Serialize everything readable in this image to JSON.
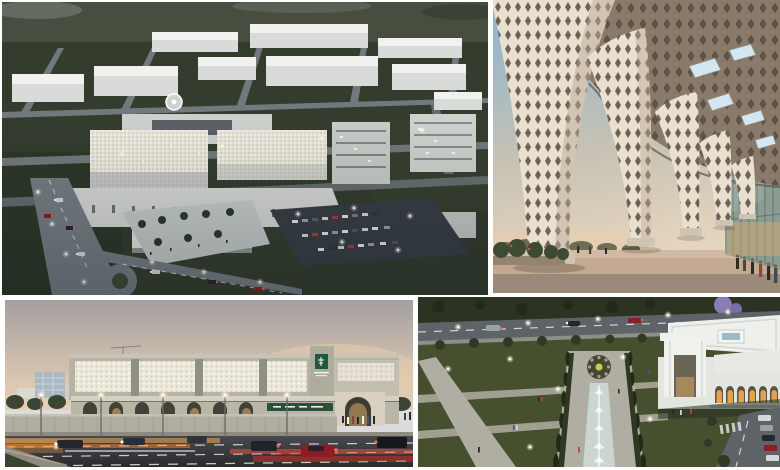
{
  "collage": {
    "type": "architectural-render-collage",
    "panel_count": 4,
    "panels": [
      {
        "id": "hospital-campus-aerial",
        "alt": "Aerial dusk rendering of a large hospital campus: white warehouse district behind, road grid on dark lawns, central beige medical complex with helipad, lit parking lot, avenue with roundabout and car lights"
      },
      {
        "id": "lattice-canopy-walkway",
        "alt": "Sunset view beneath a sculptural diamond-lattice canopy with flaring columns, rectangular skylights and a glass curtain wall with people at its base"
      },
      {
        "id": "hospital-street-elevation",
        "alt": "Street-level dusk rendering of a hospital with perforated mashrabiya facade panels, green signage, arched colonnade, boundary wall, jacaranda tree and traffic light trails"
      },
      {
        "id": "entrance-garden-aerial",
        "alt": "Aerial dusk rendering of a formal garden axis with water channel and fountains, cypress trees, stone walkways, white gateway pavilion with glowing arches, roads and parked cars"
      }
    ]
  },
  "palette": {
    "canvas_bg": "#ffffff",
    "p1_trees": "#474e40",
    "p1_field": "#333c2d",
    "p1_field_dark": "#2b3425",
    "p1_road": "#767d82",
    "p1_warehouse_top": "#f1f1ef",
    "p1_warehouse_front": "#d9dbd8",
    "p1_facade": "#d6d8d3",
    "p1_facade_pattern": "#e9e6da",
    "p1_parking": "#383e44",
    "p1_plaza": "#c6ccc9",
    "p1_taillight": "#d2423a",
    "p2_sky_top": "#8ab3d1",
    "p2_sky_mid": "#c6c2b4",
    "p2_sky_bottom": "#ecd9c0",
    "p2_lattice": "#e9e0d0",
    "p2_lattice_hole": "#6e6257",
    "p2_canopy": "#8a7a69",
    "p2_canopy_hole": "#5e5348",
    "p2_skylight": "#d3e7f2",
    "p2_glass": "#8b9c93",
    "p2_glass_line": "#5c6a62",
    "p2_floor": "#c2a98f",
    "p2_bush": "#3f4a33",
    "p3_sky_top": "#a3a0a1",
    "p3_sky_low": "#dcc7b0",
    "p3_facade": "#b6b3a4",
    "p3_panel": "#ece7db",
    "p3_pier": "#8f9080",
    "p3_canopy": "#d4d1c2",
    "p3_wall": "#b2ada2",
    "p3_sign_green": "#27513a",
    "p3_logo_green": "#1e5b3e",
    "p3_road_top": "#4a4a4e",
    "p3_road_bottom": "#2b2b2e",
    "p3_trail_orange": "#ff8d2e",
    "p3_trail_red": "#ff4434",
    "p3_car_red": "#8e1c22",
    "p3_purple": "#8d7fb0",
    "p4_lawn": "#46502f",
    "p4_lawn_dark": "#2b3322",
    "p4_path": "#b0aea2",
    "p4_water": "#ccd6d0",
    "p4_road": "#5d6366",
    "p4_roof": "#eef0ec",
    "p4_wall": "#e3e5df",
    "p4_arch_glow": "#e2a24e",
    "p4_purple": "#8a7cb4",
    "p4_shadow_green": "#242b20"
  }
}
